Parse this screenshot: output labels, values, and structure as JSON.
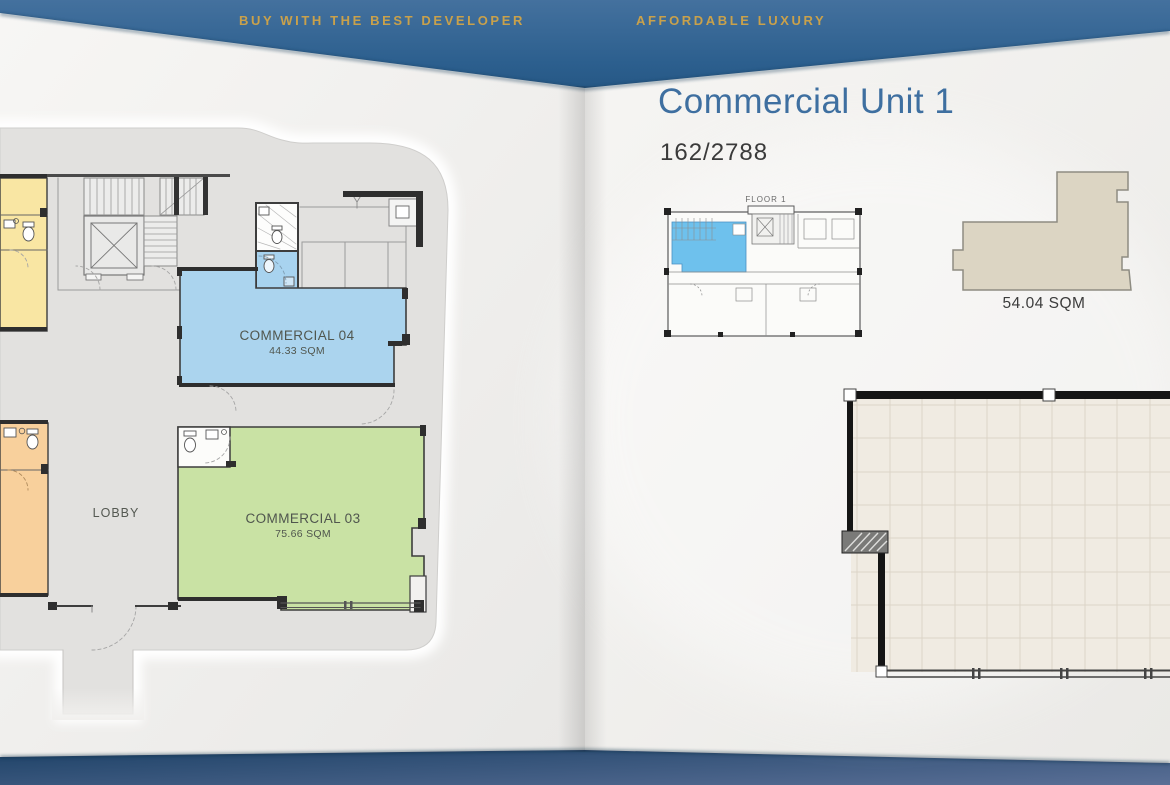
{
  "banner": {
    "left_tagline": "BUY WITH THE BEST DEVELOPER",
    "right_tagline": "AFFORDABLE LUXURY"
  },
  "right_page": {
    "title": "Commercial Unit 1",
    "unit_number": "162/2788",
    "key_plan_floor_label": "FLOOR 1",
    "unit_area_label": "54.04 SQM"
  },
  "left_page": {
    "rooms": {
      "commercial04": {
        "name": "COMMERCIAL 04",
        "area": "44.33 SQM"
      },
      "commercial03": {
        "name": "COMMERCIAL 03",
        "area": "75.66 SQM"
      },
      "lobby": {
        "name": "LOBBY"
      }
    }
  },
  "colors": {
    "banner_blue": "#2c5f8e",
    "gold": "#c9a14b",
    "title_blue": "#3e6fa0",
    "commercial04_fill": "#abd4ee",
    "commercial03_fill": "#c9e2a4",
    "yellow_room": "#f9e6a3",
    "orange_room": "#f8d09c",
    "bath_blue": "#a8d3ef",
    "key_plan_highlight": "#6ec1ed",
    "unit_silhouette": "#dcd5c3"
  }
}
